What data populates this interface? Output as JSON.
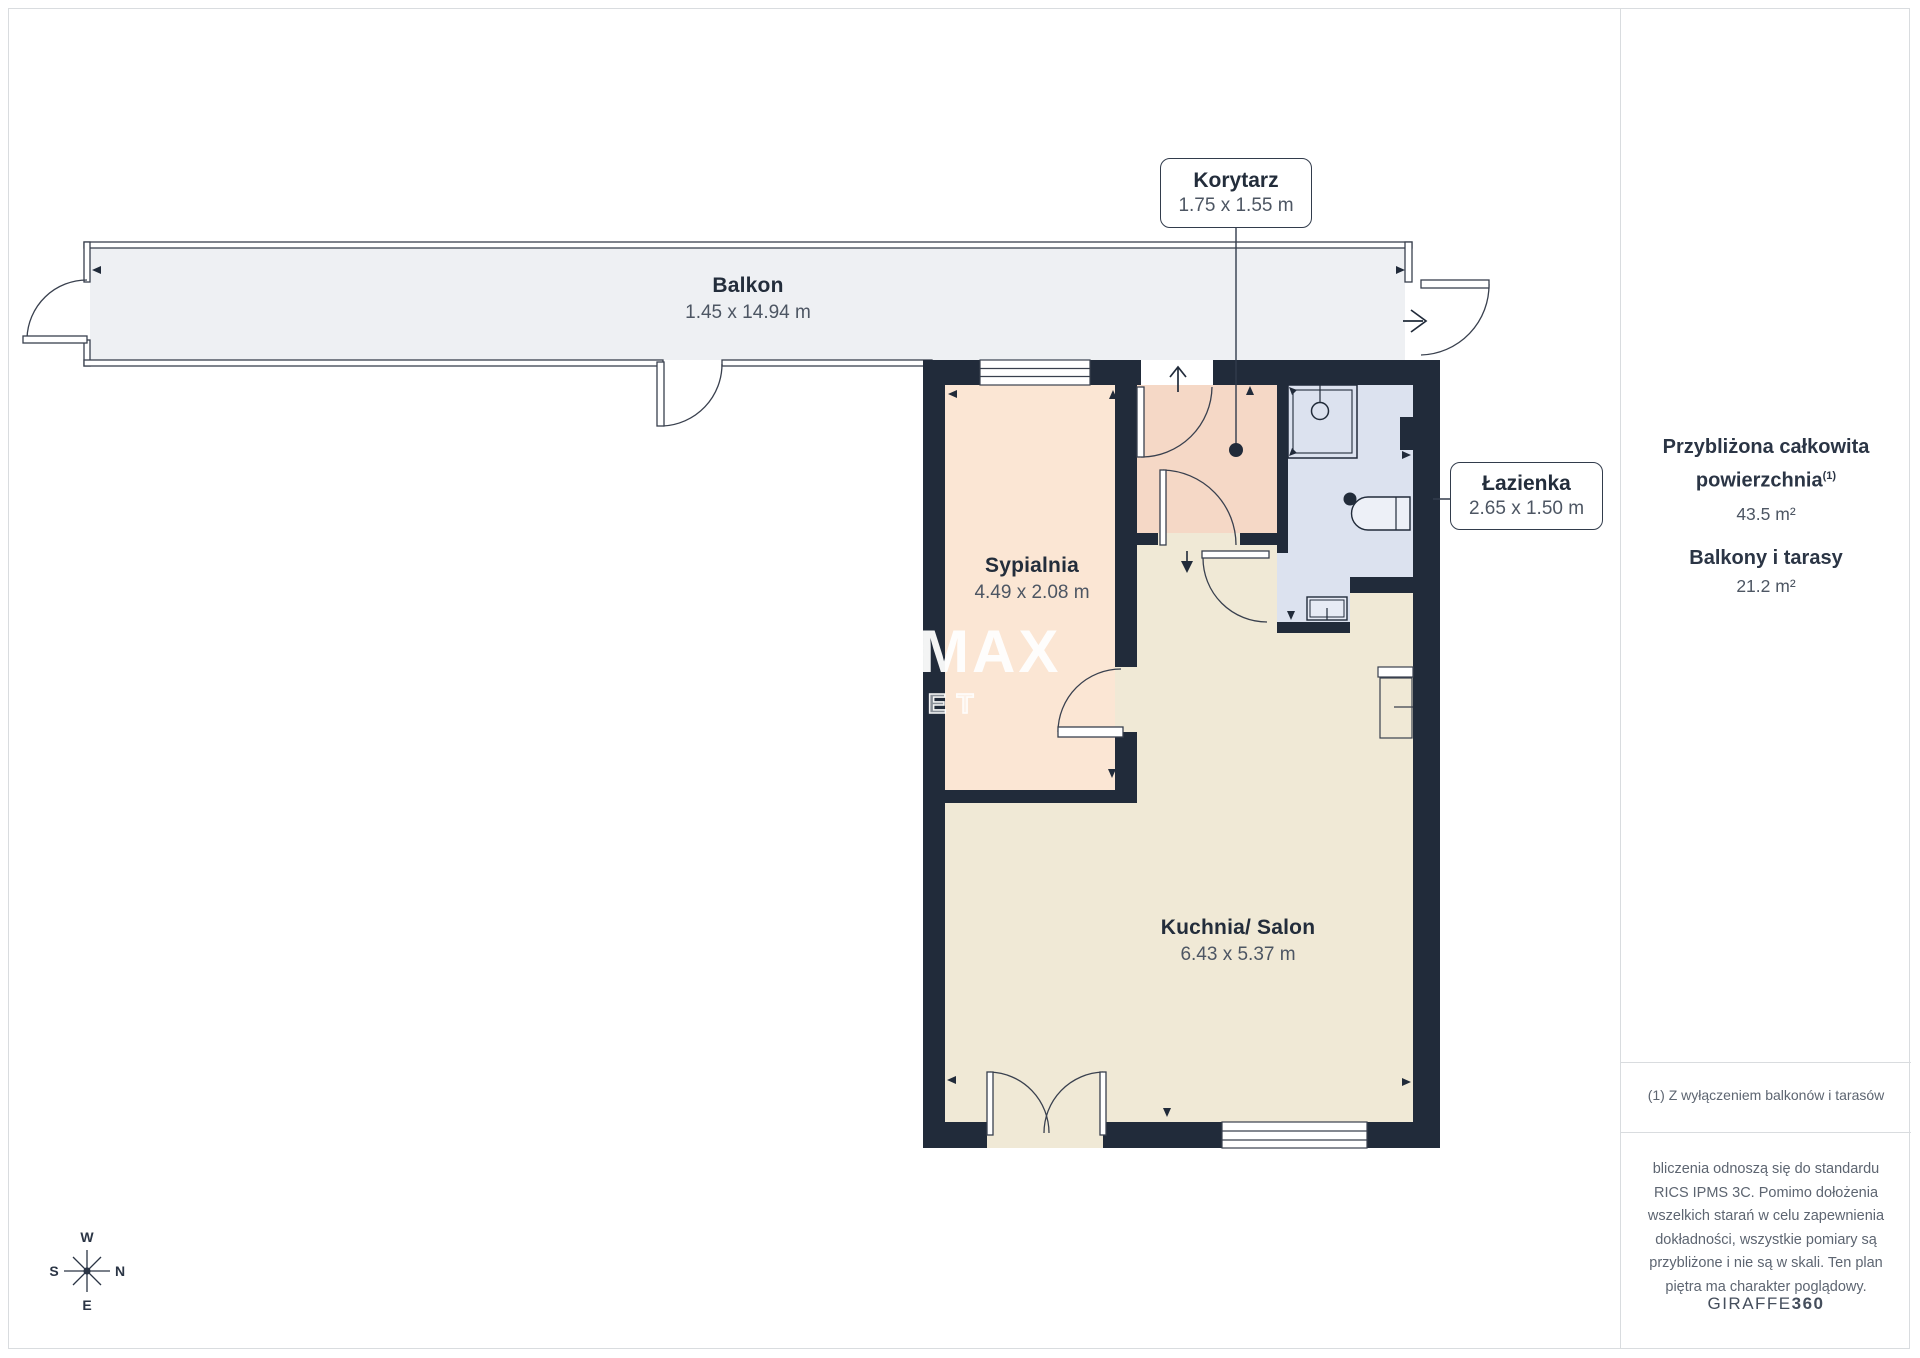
{
  "rooms": {
    "balkon": {
      "name": "Balkon",
      "dims": "1.45 x 14.94 m"
    },
    "korytarz": {
      "name": "Korytarz",
      "dims": "1.75 x 1.55 m"
    },
    "sypialnia": {
      "name": "Sypialnia",
      "dims": "4.49 x 2.08 m"
    },
    "lazienka": {
      "name": "Łazienka",
      "dims": "2.65 x 1.50 m"
    },
    "kuchnia": {
      "name": "Kuchnia/ Salon",
      "dims": "6.43 x 5.37 m"
    }
  },
  "sidebar": {
    "area_title_line1": "Przybliżona całkowita",
    "area_title_line2": "powierzchnia",
    "area_title_sup": "(1)",
    "area_value": "43.5 m²",
    "balconies_title": "Balkony i tarasy",
    "balconies_value": "21.2 m²",
    "footnote": "(1) Z wyłączeniem balkonów i tarasów",
    "disclaimer_lines": [
      "bliczenia odnoszą się do standardu",
      "RICS IPMS 3C. Pomimo dołożenia",
      "wszelkich starań w celu zapewnienia",
      "dokładności, wszystkie pomiary są",
      "przybliżone i nie są w skali. Ten plan",
      "piętra ma charakter poglądowy."
    ],
    "brand_name": "GIRAFFE",
    "brand_suffix": "360"
  },
  "watermark": {
    "re": "RE",
    "slash": "/",
    "max": "MAX",
    "sub": "SUNSET"
  },
  "compass": {
    "top": "W",
    "left": "S",
    "right": "N",
    "bottom": "E"
  },
  "colors": {
    "wall": "#212b3a",
    "balcony_floor": "#eef0f3",
    "bedroom_floor": "#fbe6d4",
    "corridor_floor": "#f5d8c6",
    "bathroom_floor": "#dce2ef",
    "kitchen_floor": "#f0e9d6",
    "thin_line": "#39404e",
    "divider": "#d9dcdf"
  }
}
